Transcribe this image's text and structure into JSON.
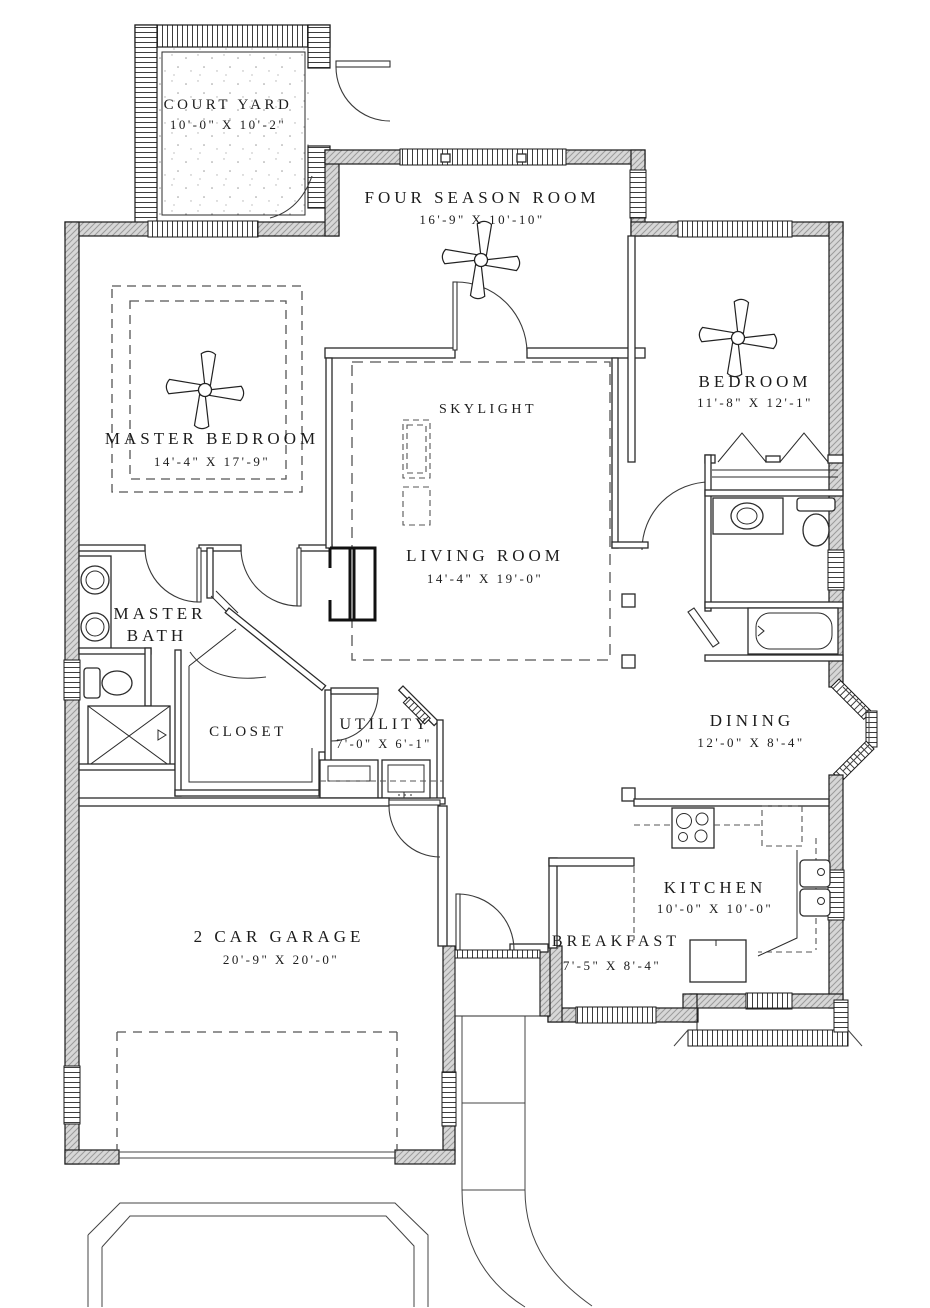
{
  "drawing": {
    "type": "residential-floor-plan",
    "colors": {
      "line": "#1c1c1c",
      "wall_fill": "#d7d7d7",
      "dash": "#555555",
      "background": "#ffffff"
    },
    "rooms": {
      "court_yard": {
        "name": "COURT YARD",
        "dims": "10'-0\" X 10'-2\""
      },
      "four_season_room": {
        "name": "FOUR SEASON ROOM",
        "dims": "16'-9\" X 10'-10\""
      },
      "master_bedroom": {
        "name": "MASTER BEDROOM",
        "dims": "14'-4\" X 17'-9\""
      },
      "bedroom": {
        "name": "BEDROOM",
        "dims": "11'-8\" X 12'-1\""
      },
      "skylight": {
        "name": "SKYLIGHT"
      },
      "living_room": {
        "name": "LIVING ROOM",
        "dims": "14'-4\" X 19'-0\""
      },
      "master_bath": {
        "line1": "MASTER",
        "line2": "BATH"
      },
      "closet": {
        "name": "CLOSET"
      },
      "utility": {
        "name": "UTILITY",
        "dims": "7'-0\" X 6'-1\""
      },
      "dining": {
        "name": "DINING",
        "dims": "12'-0\" X 8'-4\""
      },
      "garage": {
        "name": "2 CAR GARAGE",
        "dims": "20'-9\" X 20'-0\""
      },
      "kitchen": {
        "name": "KITCHEN",
        "dims": "10'-0\" X 10'-0\""
      },
      "breakfast": {
        "name": "BREAKFAST",
        "dims": "7'-5\" X 8'-4\""
      }
    }
  }
}
